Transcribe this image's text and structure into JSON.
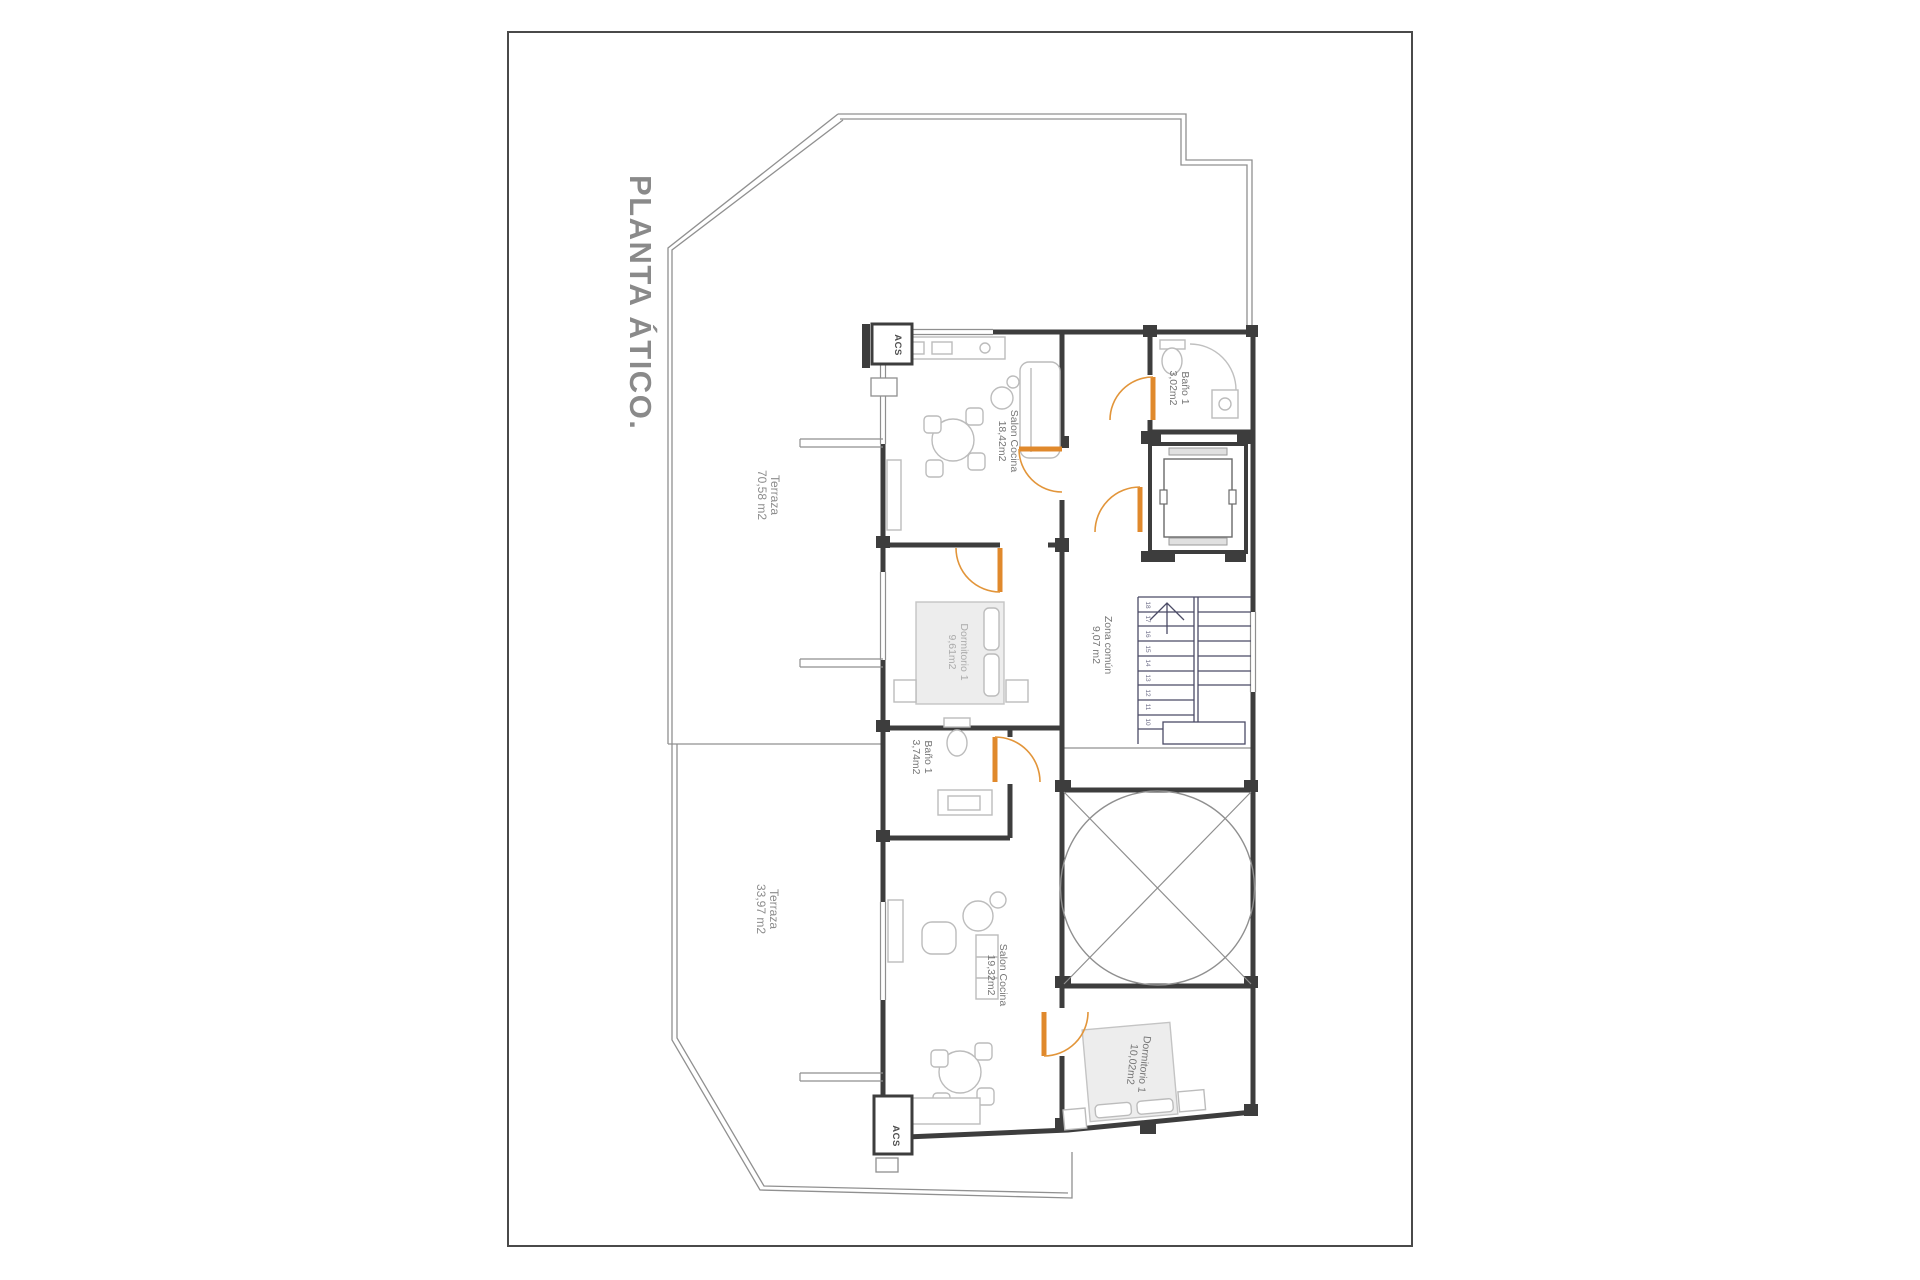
{
  "title": "PLANTA ÁTICO.",
  "rooms": {
    "terraza_upper": {
      "name": "Terraza",
      "area": "70,58 m2"
    },
    "salon_upper": {
      "name": "Salon Cocina",
      "area": "18,42m2"
    },
    "bano_upper": {
      "name": "Baño 1",
      "area": "3,02m2"
    },
    "dormitorio_upper": {
      "name": "Dormitorio 1",
      "area": "9,61m2"
    },
    "zona_comun": {
      "name": "Zona común",
      "area": "9,07 m2"
    },
    "bano_lower": {
      "name": "Baño 1",
      "area": "3,74m2"
    },
    "terraza_lower": {
      "name": "Terraza",
      "area": "33,97 m2"
    },
    "salon_lower": {
      "name": "Salon Cocina",
      "area": "19,32m2"
    },
    "dormitorio_lower": {
      "name": "Dormitorio 1",
      "area": "10,02m2"
    }
  },
  "utilities": {
    "acs_upper": "ACS",
    "acs_lower": "ACS"
  },
  "stairs": {
    "treads": [
      "10",
      "11",
      "12",
      "13",
      "14",
      "15",
      "16",
      "17",
      "18"
    ]
  },
  "colors": {
    "wall": "#3d3d3d",
    "thin_line": "#8f8f8f",
    "furniture": "#bcbcbc",
    "stair_line": "#4b4b66",
    "door_accent": "#e0892c",
    "label_gray": "#757575",
    "title_gray": "#8a8a8a"
  }
}
